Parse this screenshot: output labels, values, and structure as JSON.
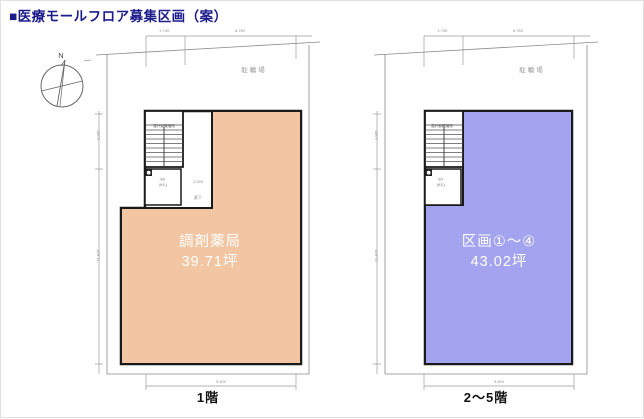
{
  "title": "■医療モールフロア募集区画（案）",
  "colors": {
    "accent_navy": "#1b1b8c",
    "floor1_fill": "#f2c6a2",
    "upper_fill": "#a3a3ef"
  },
  "compass": {
    "north_label": "N"
  },
  "plans": [
    {
      "floor_label": "1階",
      "area_name": "調剤薬局",
      "area_size": "39.71坪",
      "fill_color": "#f2c6a2",
      "bike_label": "駐輪場",
      "stair_label": "屋外避難階段",
      "ev_label": "EV",
      "ev_capacity": "(9人)",
      "corridor_dim": "2,045",
      "corridor_label": "廊下",
      "dims": {
        "top_left": "2,740",
        "top_right": "6,760",
        "bottom": "9,500",
        "side_upper": "3,185",
        "side_lower": "11,815"
      }
    },
    {
      "floor_label": "2〜5階",
      "area_name": "区画①〜④",
      "area_size": "43.02坪",
      "fill_color": "#a3a3ef",
      "bike_label": "駐輪場",
      "stair_label": "屋外避難階段",
      "ev_label": "EV",
      "ev_capacity": "(9人)",
      "dims": {
        "top_left": "2,740",
        "top_right": "6,760",
        "bottom": "9,500",
        "side_upper": "3,185",
        "side_lower": "11,815"
      }
    }
  ]
}
